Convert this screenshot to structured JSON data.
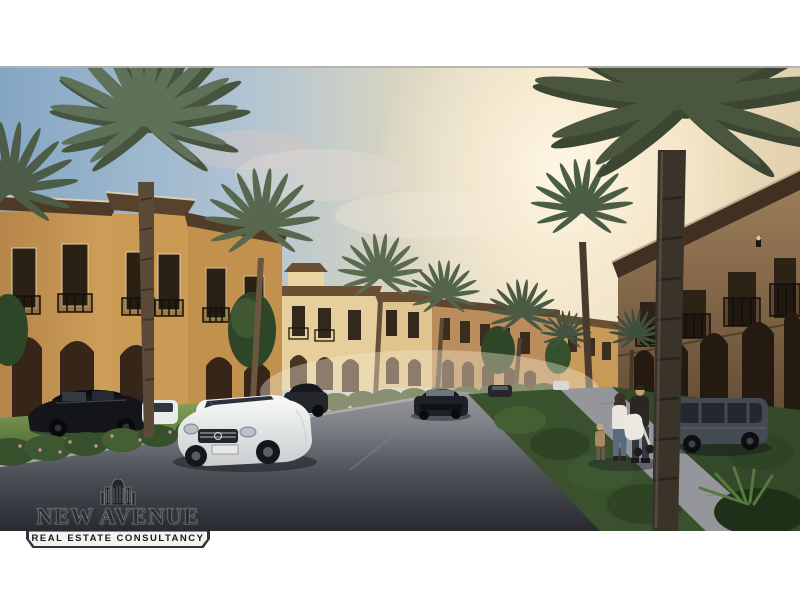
{
  "watermark": {
    "icon_name": "skyline-buildings-icon",
    "brand": "NEW AVENUE",
    "tagline": "REAL ESTATE CONSULTANCY"
  },
  "scene": {
    "kind": "architectural-render-photo",
    "caption": "Street view of a Mediterranean-style villa compound at sunset: ochre two-storey villas with iron balconies and arched arcades on both sides of a curving asphalt road, tall palm trees, a white sedan driving toward the viewer, parked dark cars, a grey car on the right, and a family with a stroller walking on the right sidewalk",
    "palette": {
      "sky_blue": "#84a6c4",
      "sun_glow": "#fff4dd",
      "villa_sunlit": "#cb9a55",
      "villa_cream": "#e6cf9c",
      "villa_shaded": "#7c5f42",
      "roof_brown": "#4e3b27",
      "palm_green": "#57694f",
      "palm_trunk": "#5b4a37",
      "road_near": "#272b31",
      "road_far": "#97989c",
      "lawn_green": "#6f8f46",
      "car_white": "#eff1f0",
      "car_black": "#131519"
    }
  }
}
